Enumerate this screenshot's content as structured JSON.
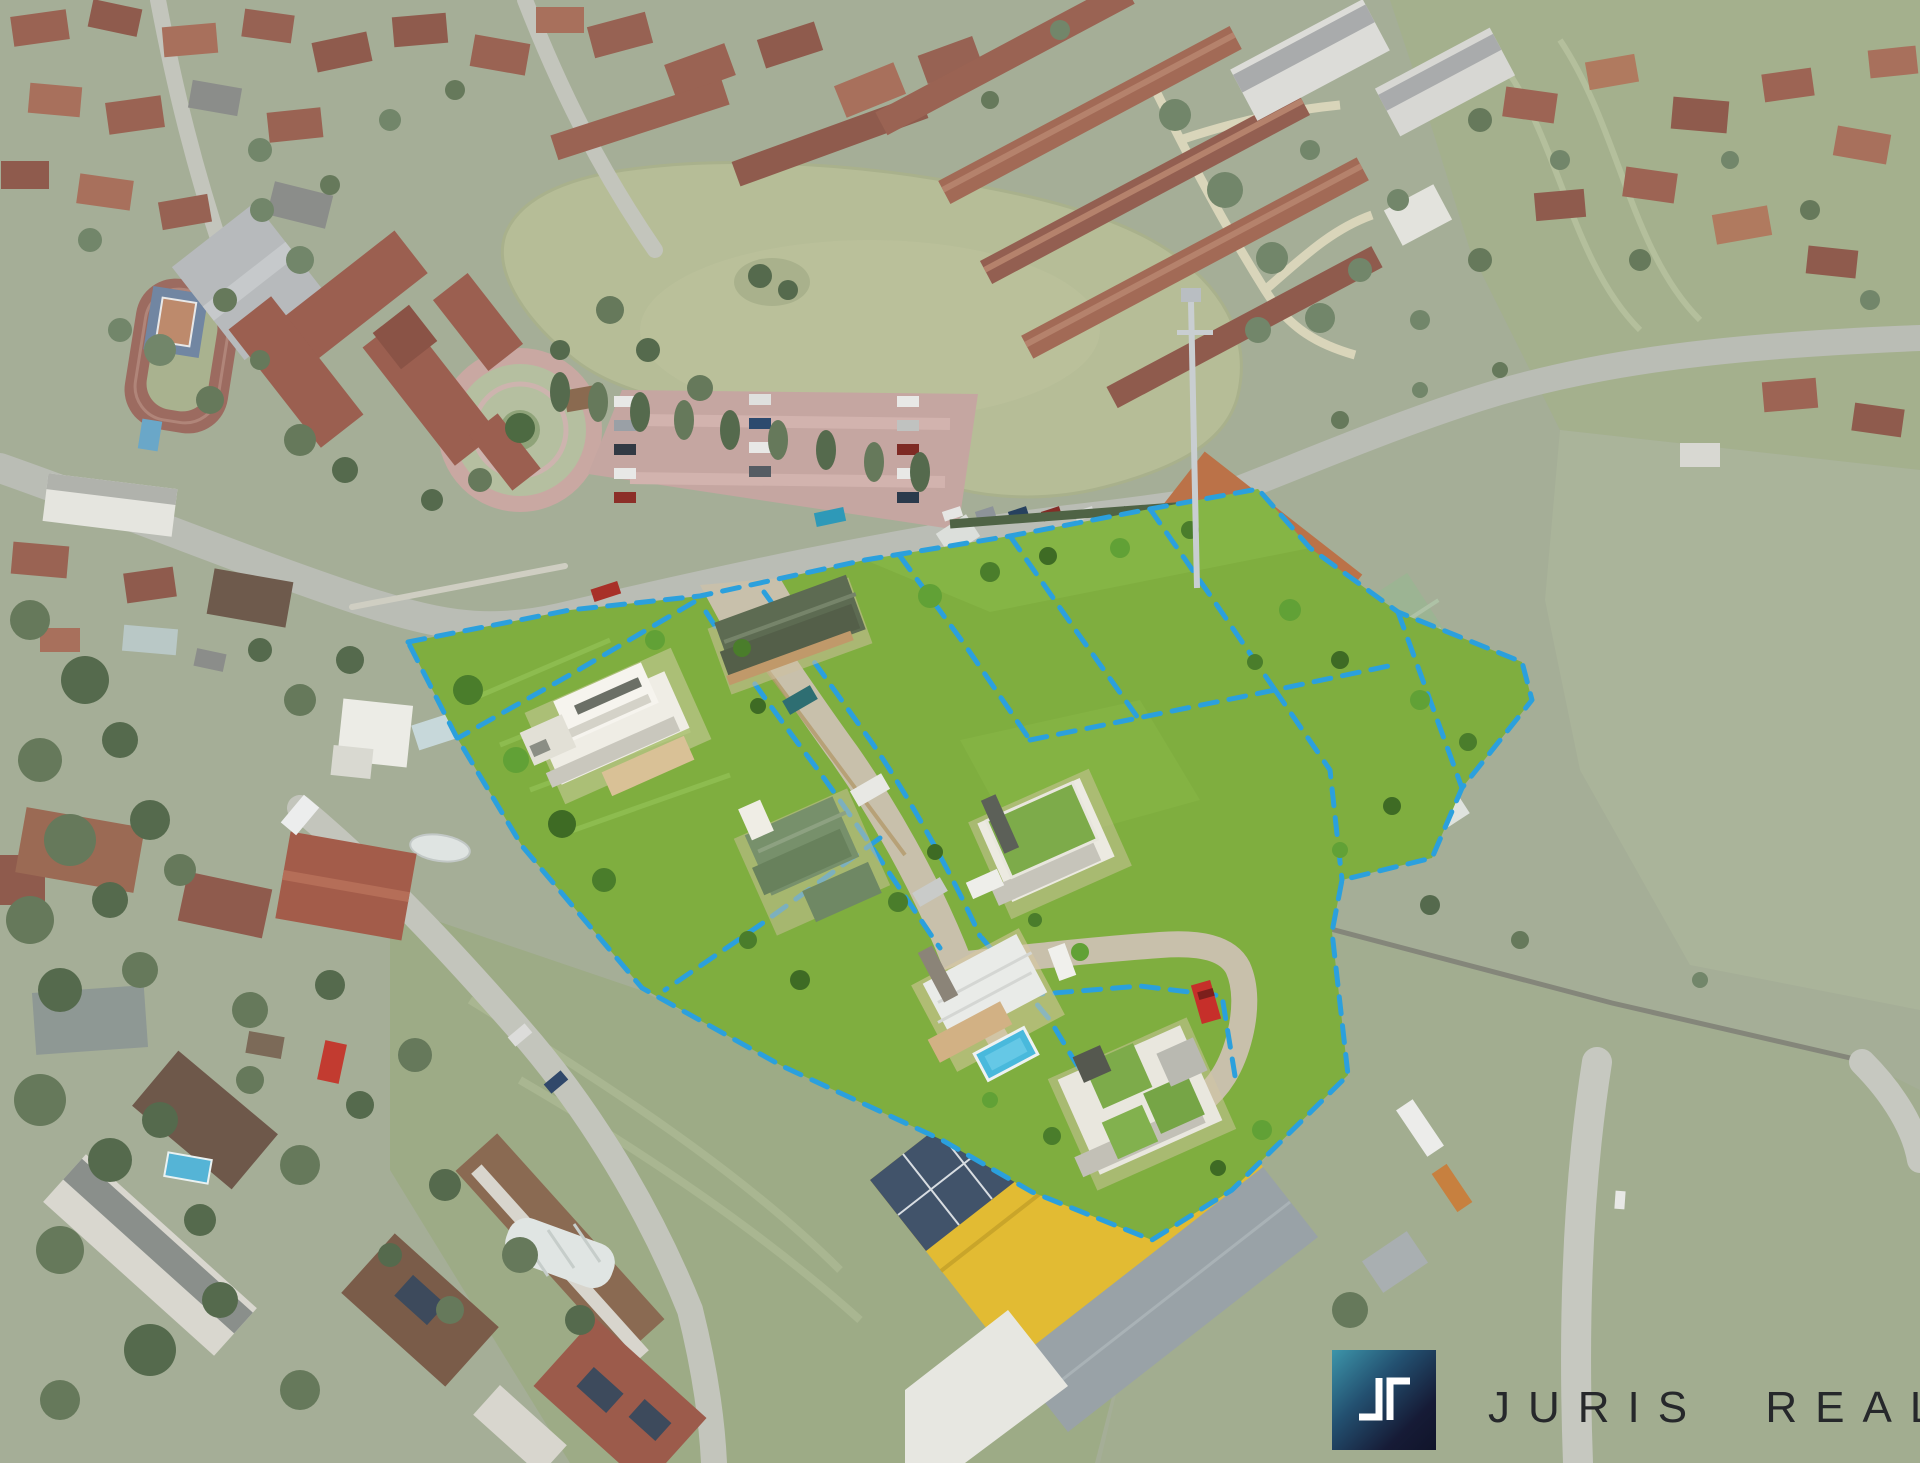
{
  "meta": {
    "media": "aerial-drone-photograph",
    "width_px": 1920,
    "height_px": 1463,
    "orientation": "oblique-top-down"
  },
  "watermark": {
    "brand": "JURIS REAL",
    "monogram_glyphs": "JR",
    "tile_colors": {
      "teal": "#3d95aa",
      "navy": "#10142a",
      "glyph": "#ffffff"
    },
    "text_color": "#26282b"
  },
  "scene": {
    "subject": "suburban land development with highlighted building plots, dashed plot boundaries and rendered future family houses",
    "highlight_colors": {
      "plot_grass": "#7fae3f",
      "plot_boundary_dashed": "#2ba0dd",
      "access_road": "#c8c0ab"
    },
    "landmarks": [
      {
        "name": "pond",
        "color": "#b6bd97"
      },
      {
        "name": "school-campus",
        "detail": "red-roof school with running track, tennis court, circular courtyard and parking lot"
      },
      {
        "name": "housing-estate-north",
        "detail": "rows of red-tiled terraced houses"
      },
      {
        "name": "industrial-area",
        "detail": "brick workshops, green-roof warehouse, yellow house, communications mast"
      },
      {
        "name": "warehouse-south",
        "detail": "yellow roof with rooftop solar array"
      },
      {
        "name": "residential-southwest",
        "detail": "family houses, gardens, garden pools"
      },
      {
        "name": "rendered-houses",
        "detail": "modern villa, bungalow, gabled house, green-roof cube house, barn house with pool, atrium house"
      },
      {
        "name": "fields",
        "color": "#a4b08d"
      }
    ]
  }
}
